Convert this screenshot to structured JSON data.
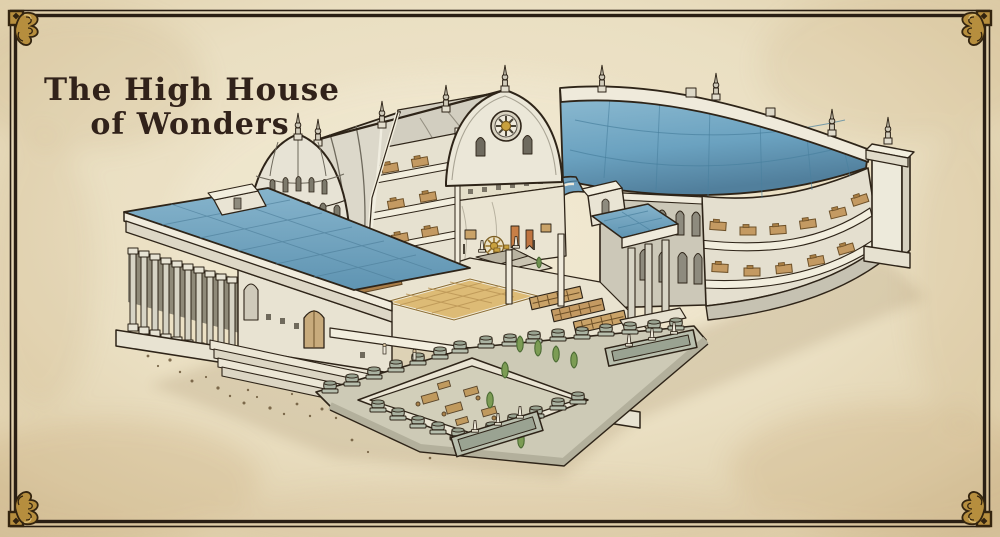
{
  "title": {
    "line1": "The High House",
    "line2": "of Wonders"
  },
  "palette": {
    "parchment": "#ece1c6",
    "parchment_edge": "#d9c5a0",
    "ink_outline": "#2e2418",
    "frame": "#2a1f14",
    "corner_gold": "#b68e3e",
    "roof_blue": "#73a7c3",
    "roof_blue_deep": "#4e82a0",
    "stone_light": "#ece7d8",
    "stone_shadow": "#c9c4b2",
    "wood": "#c49a62",
    "gold_accent": "#c9a13e",
    "foliage": "#7c9c54",
    "banner_orange": "#c87f46",
    "mosaic_gold": "#ddbb76",
    "planter_stone": "#aab3a2"
  }
}
